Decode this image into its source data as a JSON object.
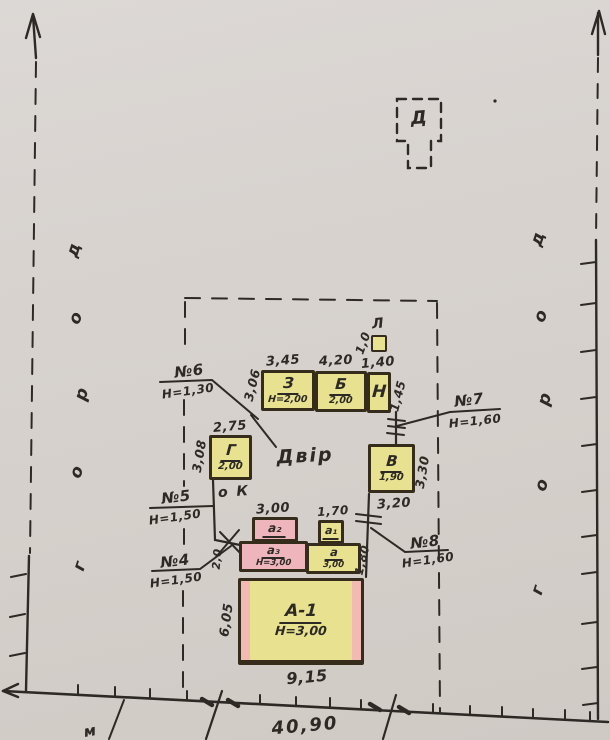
{
  "colors": {
    "paper": "#d8d3ce",
    "ink": "#2d2925",
    "building_yellow": "#e7e190",
    "building_pink": "#efb5bc",
    "building_border": "#362c1c"
  },
  "buildings": {
    "house": {
      "label": "А-1",
      "height": "Н=3,00",
      "width_dim": "9,15",
      "side_dim": "6,05"
    },
    "z": {
      "label": "З",
      "height": "Н=2,00",
      "top_dim": "3,45",
      "side_dim": "3,06"
    },
    "b": {
      "label": "Б",
      "height": "2,00",
      "top_dim": "4,20"
    },
    "n": {
      "label": "Н",
      "top_dim": "1,40",
      "side_dim": "1,45"
    },
    "l": {
      "label": "Л",
      "side_dim": "1,0"
    },
    "g": {
      "label": "Г",
      "height": "2,00",
      "top_dim": "2,75",
      "side_dim": "3,08"
    },
    "v": {
      "label": "В",
      "height": "1,90",
      "side_dim": "3,30",
      "bottom_dim": "3,20"
    },
    "a2": {
      "label": "а₂",
      "top_dim": "3,00"
    },
    "a1": {
      "label": "а₁",
      "top_dim": "1,70"
    },
    "a3": {
      "label": "а₃",
      "height": "Н=3,00",
      "side_dim": "2,0"
    },
    "a": {
      "label": "а",
      "height": "3,00",
      "side_dim": "1,80"
    },
    "d": {
      "label": "Д"
    }
  },
  "boundary_points": [
    {
      "label": "№6",
      "value": "Н=1,30"
    },
    {
      "label": "№5",
      "value": "Н=1,50"
    },
    {
      "label": "№4",
      "value": "Н=1,50"
    },
    {
      "label": "№7",
      "value": "Н=1,60"
    },
    {
      "label": "№8",
      "value": "Н=1,60"
    }
  ],
  "annotations": {
    "yard": "Двір",
    "well": "о К",
    "frontage_dim": "40,90",
    "corner_note": "м"
  },
  "road_left_letters": [
    "д",
    "о",
    "р",
    "о",
    "г"
  ],
  "road_right_letters": [
    "д",
    "о",
    "р",
    "о",
    "г"
  ]
}
